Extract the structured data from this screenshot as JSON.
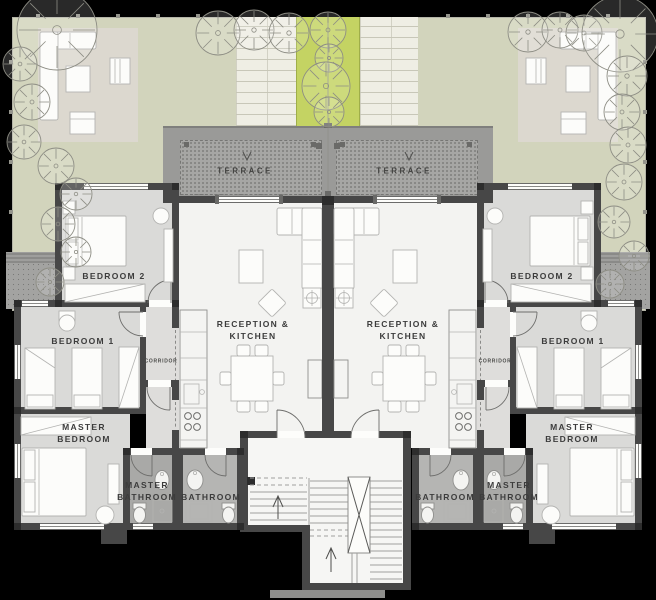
{
  "labels": {
    "terrace": "TERRACE",
    "reception": "RECEPTION &\nKITCHEN",
    "bedroom1": "BEDROOM 1",
    "bedroom2": "BEDROOM 2",
    "master_bedroom": "MASTER\nBEDROOM",
    "master_bathroom": "MASTER\nBATHROOM",
    "bathroom": "BATHROOM",
    "corridor": "CORRIDOR"
  },
  "colors": {
    "background": "#000000",
    "garden": "#d2d4bc",
    "patio": "#dcd8cf",
    "green_strip": "#c4d363",
    "walkway": "#efeee4",
    "terrace_band": "#9a9a98",
    "terrace_floor": "#a6a6a4",
    "wall": "#474747",
    "wall_dark": "#2d2d2d",
    "bedroom_floor": "#dadad8",
    "reception_floor": "#f3f3f1",
    "corridor_floor": "#dedddb",
    "bathroom_floor": "#b5b5b3",
    "master_bathroom_floor": "#a9a9a7",
    "hall_floor": "#f6f6f4",
    "landing": "#8e8e8c",
    "furniture_stroke": "#b3b3b1",
    "label": "#3c3c3c"
  }
}
